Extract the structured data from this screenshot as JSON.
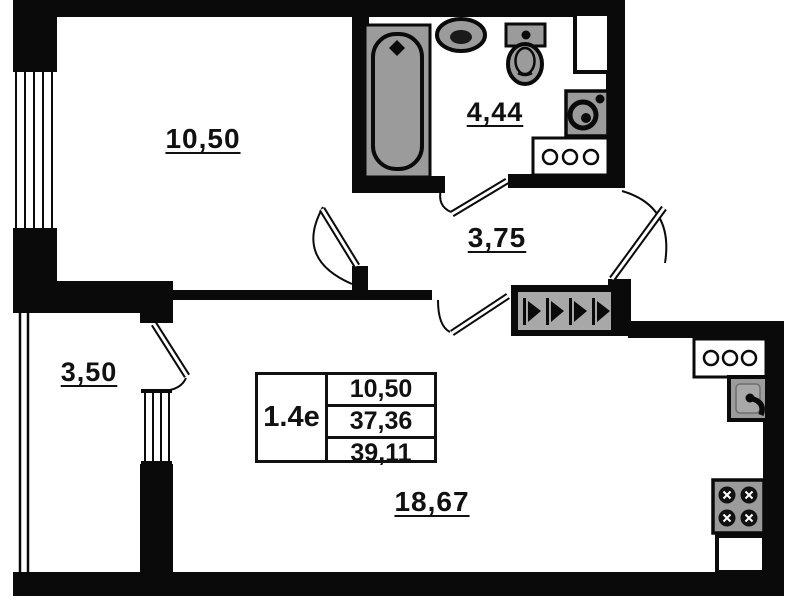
{
  "floorplan": {
    "unit_label": "1.4е",
    "info_table": {
      "values": [
        "10,50",
        "37,36",
        "39,11"
      ]
    },
    "rooms": {
      "bedroom": {
        "area": "10,50"
      },
      "bathroom": {
        "area": "4,44"
      },
      "hallway": {
        "area": "3,75"
      },
      "balcony": {
        "area": "3,50"
      },
      "kitchen_living": {
        "area": "18,67"
      }
    },
    "fixtures": [
      "bathtub",
      "washbasin",
      "toilet",
      "washing-machine",
      "bathroom-counter",
      "wardrobe",
      "kitchen-counter",
      "kitchen-sink",
      "stove",
      "kitchen-cabinet"
    ],
    "colors": {
      "wall": "#000000",
      "fixture_fill": "#9b9b9b",
      "background": "#ffffff"
    }
  }
}
